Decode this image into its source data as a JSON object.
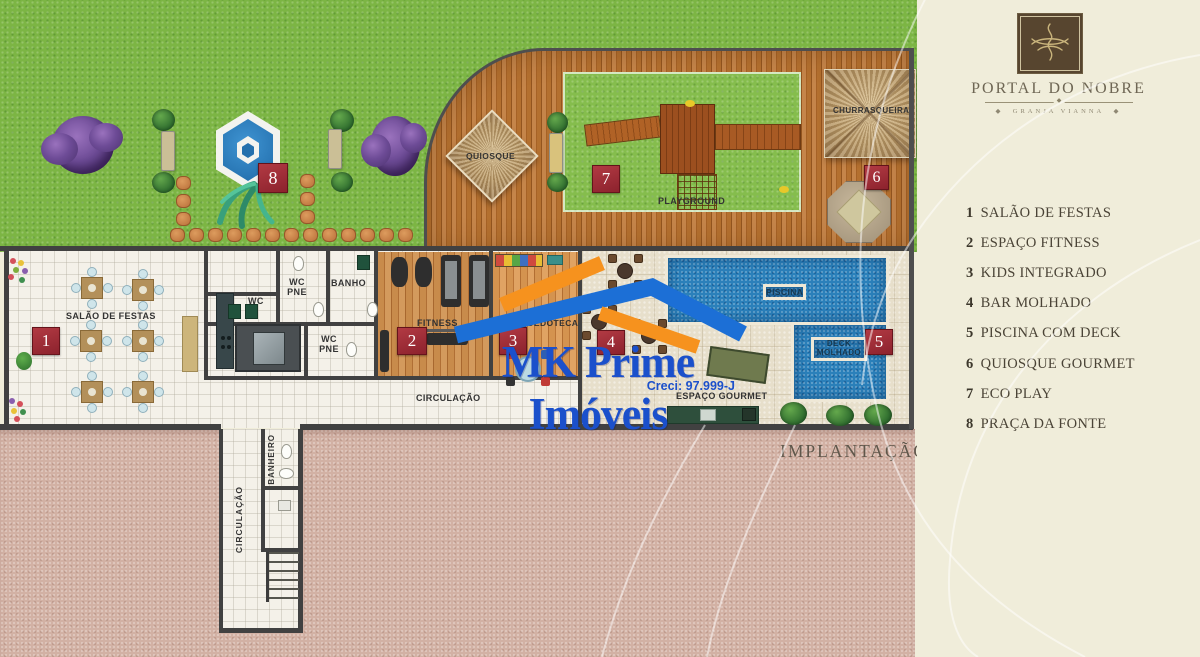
{
  "brand": {
    "title": "PORTAL DO NOBRE",
    "subtitle": "GRANJA VIANNA"
  },
  "legend": {
    "items": [
      {
        "num": "1",
        "label": "SALÃO DE FESTAS"
      },
      {
        "num": "2",
        "label": "ESPAÇO FITNESS"
      },
      {
        "num": "3",
        "label": "KIDS INTEGRADO"
      },
      {
        "num": "4",
        "label": "BAR MOLHADO"
      },
      {
        "num": "5",
        "label": "PISCINA COM DECK"
      },
      {
        "num": "6",
        "label": "QUIOSQUE GOURMET"
      },
      {
        "num": "7",
        "label": "ECO PLAY"
      },
      {
        "num": "8",
        "label": "PRAÇA DA FONTE"
      }
    ]
  },
  "plan": {
    "caption": "IMPLANTAÇÃO",
    "labels": {
      "salao": "SALÃO DE FESTAS",
      "wc": "WC",
      "wc_pne": "WC PNE",
      "banho": "BANHO",
      "fitness": "FITNESS",
      "brinquedoteca": "BRINQUEDOTECA",
      "circulacao": "CIRCULAÇÃO",
      "espaco_gourmet": "ESPAÇO GOURMET",
      "piscina": "PISCINA",
      "deck_molhado": "DECK MOLHADO",
      "quiosque": "QUIOSQUE",
      "playground": "PLAYGROUND",
      "churrasqueira": "CHURRASQUEIRA",
      "banheiro": "BANHEIRO"
    },
    "badges": [
      "1",
      "2",
      "3",
      "4",
      "5",
      "6",
      "7",
      "8"
    ]
  },
  "watermark": {
    "company": "MK Prime Imóveis",
    "creci": "Creci: 97.999-J"
  },
  "colors": {
    "badge_red": "#9e2b33",
    "watermark_blue": "#1b50cb",
    "watermark_orange": "#f6921e",
    "grass_green": "#7cb544",
    "pool_blue": "#2b80ba",
    "panel_beige": "#f0edda",
    "ground_pink": "#d2b1a4"
  }
}
